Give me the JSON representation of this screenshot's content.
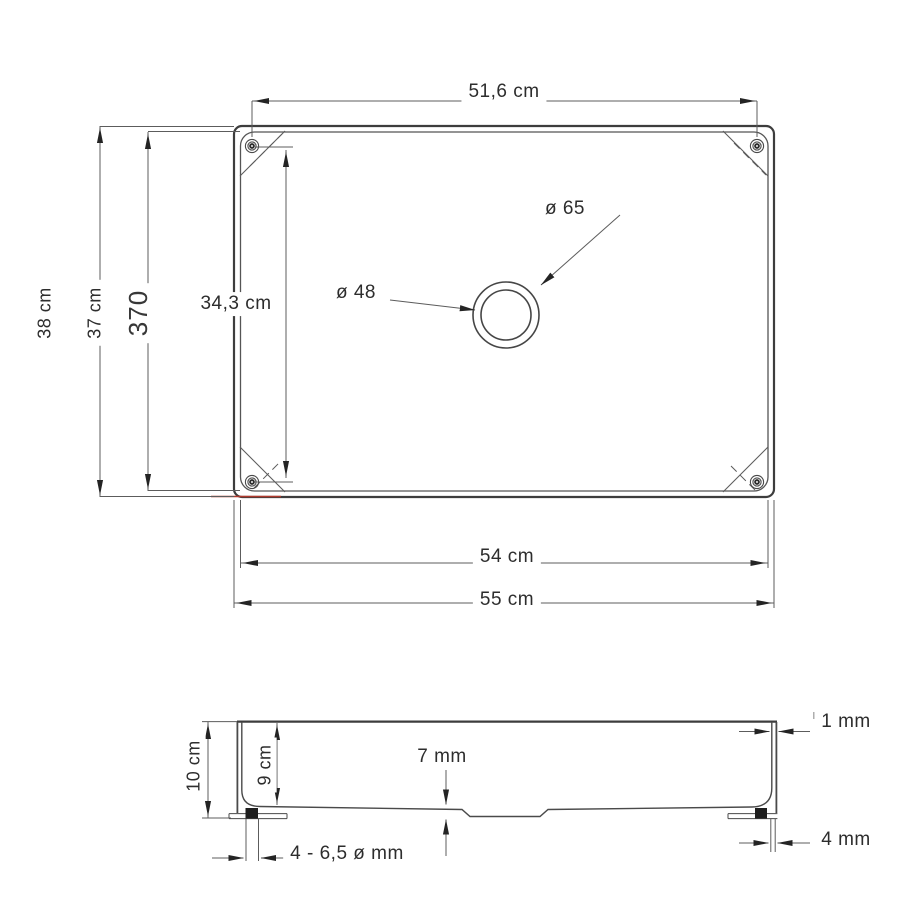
{
  "drawing": {
    "top_view": {
      "screw_span_width": "51,6 cm",
      "outer_height": "38 cm",
      "rim_height": "37 cm",
      "rim_height_mm": "370",
      "screw_span_height": "34,3 cm",
      "drain_outer_diameter": "ø 65",
      "drain_inner_diameter": "ø 48",
      "rim_width": "54 cm",
      "outer_width": "55 cm"
    },
    "side_view": {
      "outer_depth": "10 cm",
      "inner_depth": "9 cm",
      "recess_depth": "7 mm",
      "wall_thickness": "1 mm",
      "flange_thickness": "4 mm",
      "mounting_hole_diameter": "4 - 6,5 ø mm"
    },
    "colors": {
      "line": "#3d3d3d",
      "thin_line": "#5c5c5c",
      "arrow": "#242424",
      "accent_red": "#b03a2e"
    }
  }
}
